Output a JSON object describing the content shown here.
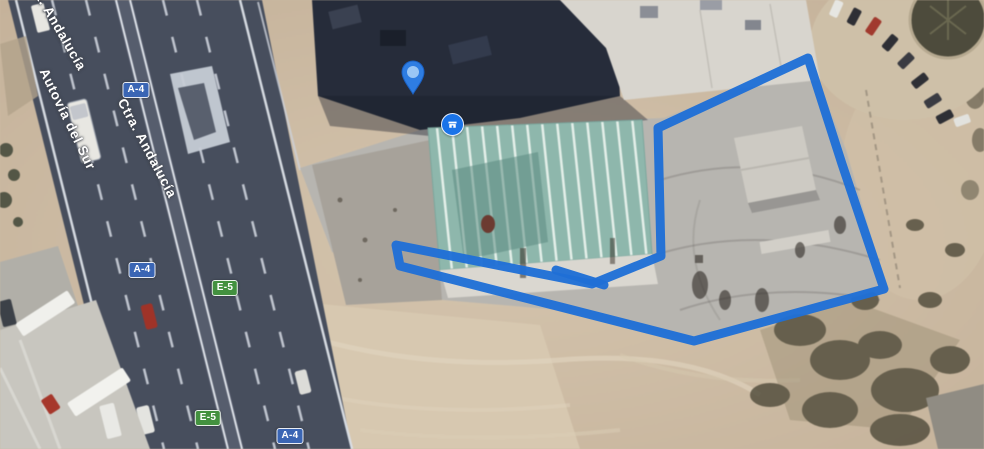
{
  "view": {
    "kind": "satellite-map",
    "width": 984,
    "height": 449
  },
  "road_labels": [
    {
      "id": "road-label-ctra-andalucia-partial",
      "text": "Ctra. Andalucía",
      "x": 34,
      "y": -30,
      "angle": 60
    },
    {
      "id": "road-label-autovia-del-sur",
      "text": "Autovía del Sur",
      "x": 50,
      "y": 66,
      "angle": 64
    },
    {
      "id": "road-label-ctra-andalucia",
      "text": "Ctra. Andalucía",
      "x": 128,
      "y": 96,
      "angle": 62
    }
  ],
  "route_badges": [
    {
      "label": "A-4",
      "variant": "motorway-blue",
      "x": 136,
      "y": 90
    },
    {
      "label": "A-4",
      "variant": "motorway-blue",
      "x": 142,
      "y": 270
    },
    {
      "label": "E-5",
      "variant": "euroroute-green",
      "x": 225,
      "y": 288
    },
    {
      "label": "E-5",
      "variant": "euroroute-green",
      "x": 208,
      "y": 418
    },
    {
      "label": "A-4",
      "variant": "motorway-blue",
      "x": 290,
      "y": 436
    }
  ],
  "markers": [
    {
      "icon": "map-pin-icon",
      "style": "teardrop-pin",
      "x": 413,
      "y": 95
    },
    {
      "icon": "business-marker-icon",
      "style": "circle-poi",
      "x": 452,
      "y": 124
    }
  ],
  "parcel_outline": {
    "color": "#1f6fd6",
    "stroke_width": 9,
    "points": [
      [
        396,
        245
      ],
      [
        592,
        284
      ],
      [
        661,
        256
      ],
      [
        658,
        128
      ],
      [
        808,
        58
      ],
      [
        842,
        164
      ],
      [
        884,
        289
      ],
      [
        694,
        341
      ],
      [
        400,
        266
      ]
    ],
    "overdraw_segment": [
      [
        556,
        270
      ],
      [
        604,
        285
      ]
    ]
  },
  "colors": {
    "road_surface": "#474e5e",
    "badge_blue": "#3a65b4",
    "badge_green": "#43913f",
    "annotation_blue": "#1f6fd6",
    "marker_blue": "#1a73e8",
    "dirt": "#cdbba3",
    "concrete": "#b7b5b0",
    "teal_roof": "#8cb7ac"
  }
}
